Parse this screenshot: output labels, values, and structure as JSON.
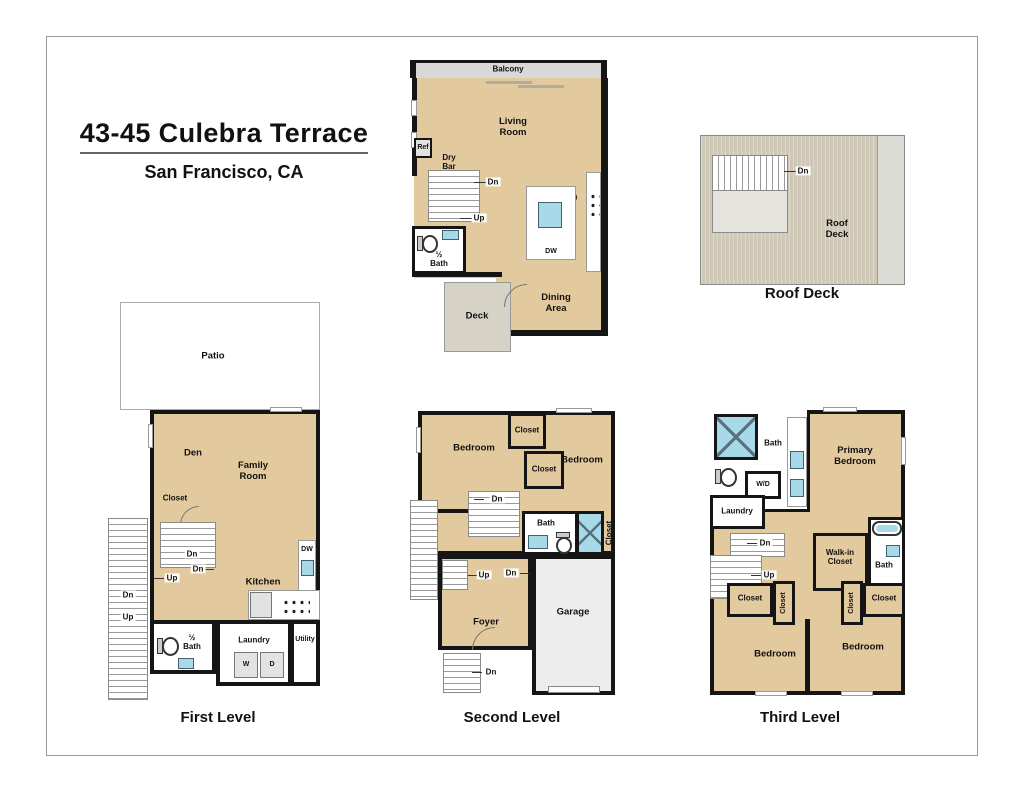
{
  "title": {
    "address": "43-45 Culebra Terrace",
    "city": "San Francisco, CA"
  },
  "captions": {
    "roof_deck": "Roof Deck",
    "first_level": "First Level",
    "second_level": "Second Level",
    "third_level": "Third Level"
  },
  "labels": {
    "balcony": "Balcony",
    "living_room": "Living\nRoom",
    "ref": "Ref",
    "dry_bar": "Dry\nBar",
    "dn": "Dn",
    "up": "Up",
    "kitchen": "Kitchen",
    "dw": "DW",
    "half_bath": "½\nBath",
    "bath": "Bath",
    "deck": "Deck",
    "dining_area": "Dining\nArea",
    "roof_deck": "Roof\nDeck",
    "patio": "Patio",
    "den": "Den",
    "family_room": "Family\nRoom",
    "closet": "Closet",
    "laundry": "Laundry",
    "utility": "Utility",
    "washer": "W",
    "dryer": "D",
    "washer_dryer": "W/D",
    "bedroom": "Bedroom",
    "foyer": "Foyer",
    "garage": "Garage",
    "primary_bedroom": "Primary\nBedroom",
    "walk_in_closet": "Walk-in\nCloset"
  },
  "colors": {
    "floor_tan": "#e3ca9e",
    "wall_black": "#151515",
    "deck_gray": "#d6d2c6",
    "roof_tan": "#cfc8b7",
    "garage_gray": "#ededed",
    "fixture_blue": "#a8d9e8",
    "balcony_gray": "#d8d8d8"
  }
}
